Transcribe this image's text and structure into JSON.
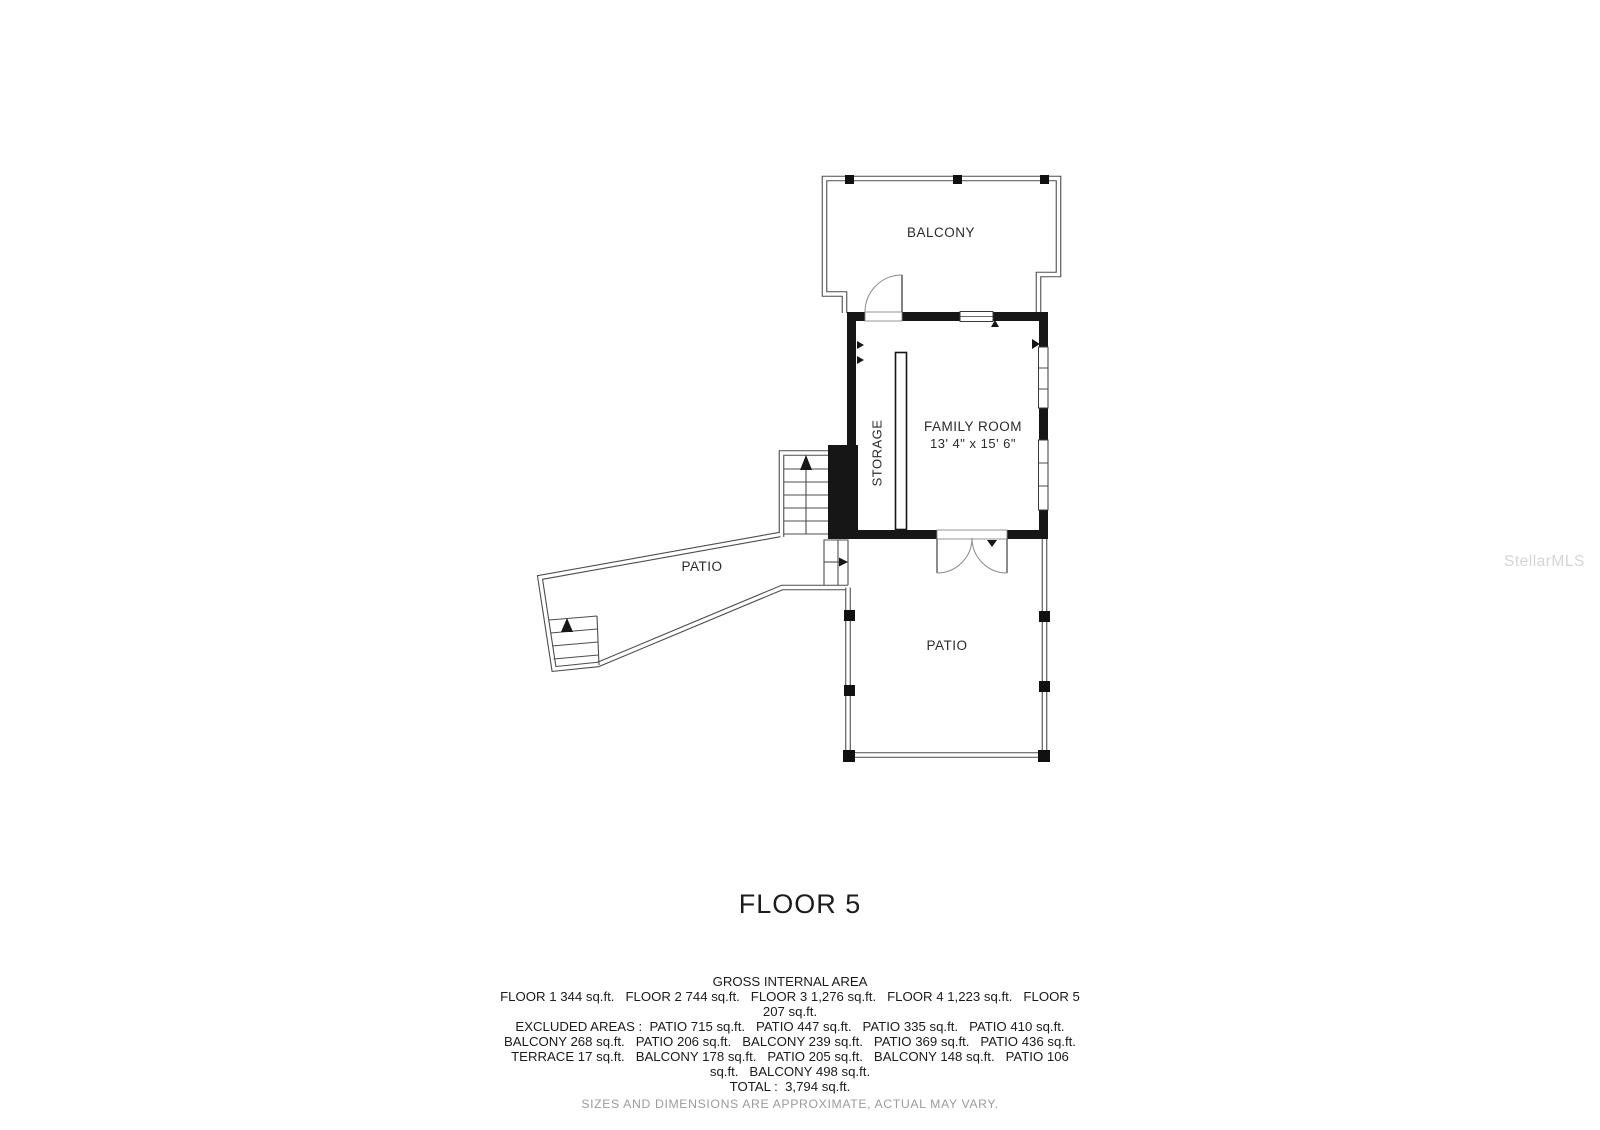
{
  "title": "FLOOR 5",
  "watermark": "StellarMLS",
  "plan": {
    "balcony_label": "BALCONY",
    "storage_label": "STORAGE",
    "family_room_label": "FAMILY ROOM",
    "family_room_dimensions": "13' 4\" x 15' 6\"",
    "patio_upper_label": "PATIO",
    "patio_lower_label": "PATIO"
  },
  "footer": {
    "heading": "GROSS INTERNAL AREA",
    "lines": [
      "FLOOR 1 344 sq.ft.   FLOOR 2 744 sq.ft.   FLOOR 3 1,276 sq.ft.   FLOOR 4 1,223 sq.ft.   FLOOR 5",
      "207 sq.ft.",
      "EXCLUDED AREAS :  PATIO 715 sq.ft.   PATIO 447 sq.ft.   PATIO 335 sq.ft.   PATIO 410 sq.ft.",
      "BALCONY 268 sq.ft.   PATIO 206 sq.ft.   BALCONY 239 sq.ft.   PATIO 369 sq.ft.   PATIO 436 sq.ft.",
      "TERRACE 17 sq.ft.   BALCONY 178 sq.ft.   PATIO 205 sq.ft.   BALCONY 148 sq.ft.   PATIO 106",
      "sq.ft.   BALCONY 498 sq.ft.",
      "TOTAL :  3,794 sq.ft."
    ],
    "disclaimer": "SIZES AND DIMENSIONS ARE APPROXIMATE, ACTUAL MAY VARY."
  },
  "colors": {
    "wall": "#161616",
    "thin_line": "#4d4d4d",
    "label_text": "#2b2b2b",
    "muted_text": "#9c9c9c",
    "watermark": "#b8b8b8",
    "background": "#ffffff"
  }
}
